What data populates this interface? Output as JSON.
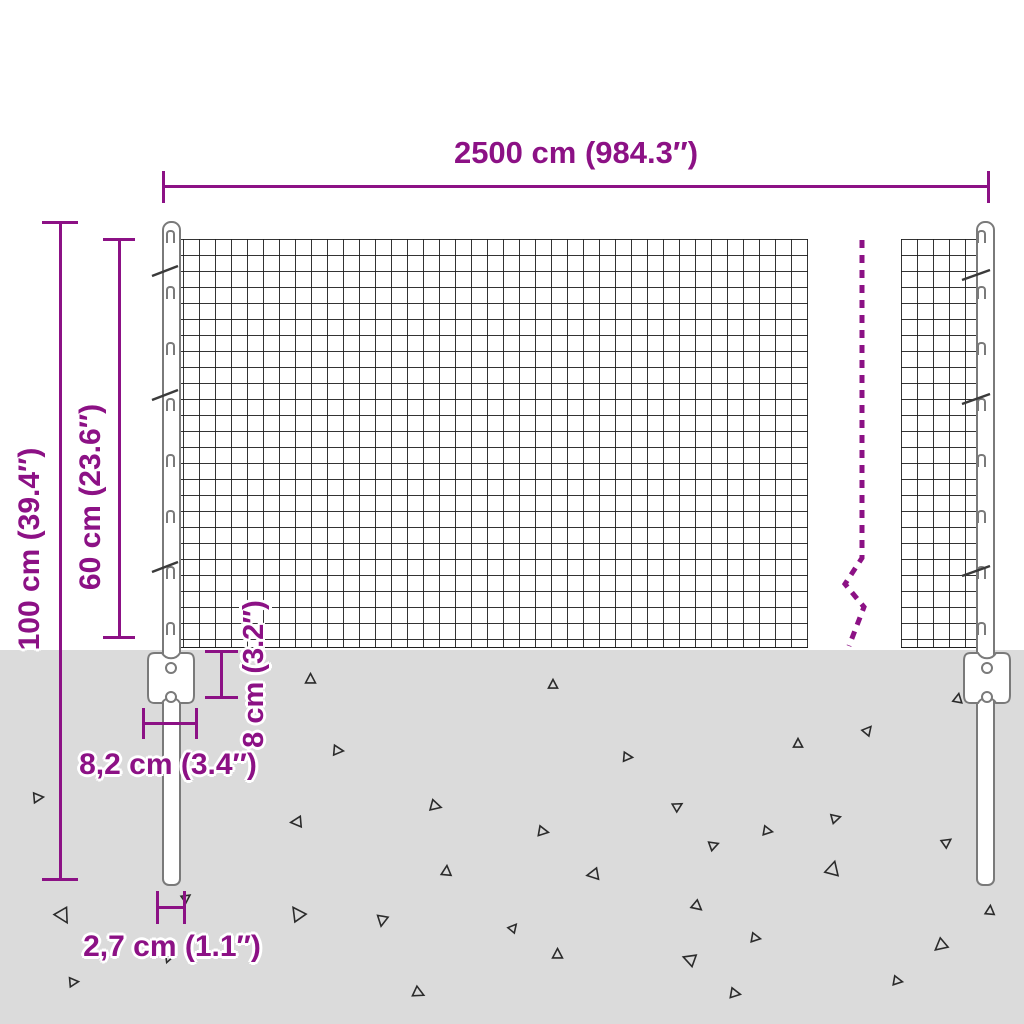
{
  "diagram": {
    "subject": "wire-mesh-fence-with-posts",
    "dimensions": {
      "width_label": "2500 cm (984.3″)",
      "total_height_label": "100 cm (39.4″)",
      "mesh_height_label": "60 cm (23.6″)",
      "bracket_height_label": "8 cm (3.2″)",
      "bracket_width_label": "8,2 cm (3.4″)",
      "post_diameter_label": "2,7 cm (1.1″)"
    }
  },
  "colors": {
    "accent": "#8C1185",
    "ground": "#DBDBDB",
    "mesh_line": "#1E1E1E",
    "post_outline": "#7A7A7A",
    "triangle": "#2B2B2B"
  },
  "ground": {
    "triangles": [
      {
        "x": 38,
        "y": 797,
        "s": 13,
        "r": 85
      },
      {
        "x": 63,
        "y": 916,
        "s": 19,
        "r": 150
      },
      {
        "x": 74,
        "y": 982,
        "s": 12,
        "r": 85
      },
      {
        "x": 186,
        "y": 897,
        "s": 11,
        "r": 55
      },
      {
        "x": 168,
        "y": 959,
        "s": 10,
        "r": 200
      },
      {
        "x": 296,
        "y": 822,
        "s": 14,
        "r": -95
      },
      {
        "x": 297,
        "y": 913,
        "s": 18,
        "r": -35
      },
      {
        "x": 310,
        "y": 678,
        "s": 13,
        "r": 0
      },
      {
        "x": 338,
        "y": 750,
        "s": 13,
        "r": 95
      },
      {
        "x": 382,
        "y": 921,
        "s": 14,
        "r": 190
      },
      {
        "x": 419,
        "y": 993,
        "s": 14,
        "r": 115
      },
      {
        "x": 436,
        "y": 806,
        "s": 14,
        "r": 105
      },
      {
        "x": 446,
        "y": 870,
        "s": 13,
        "r": 5
      },
      {
        "x": 543,
        "y": 831,
        "s": 13,
        "r": 100
      },
      {
        "x": 513,
        "y": 927,
        "s": 11,
        "r": 40
      },
      {
        "x": 553,
        "y": 684,
        "s": 12,
        "r": 0
      },
      {
        "x": 557,
        "y": 953,
        "s": 13,
        "r": 0
      },
      {
        "x": 592,
        "y": 874,
        "s": 15,
        "r": -100
      },
      {
        "x": 628,
        "y": 757,
        "s": 12,
        "r": 95
      },
      {
        "x": 678,
        "y": 806,
        "s": 12,
        "r": 60
      },
      {
        "x": 689,
        "y": 959,
        "s": 16,
        "r": -70
      },
      {
        "x": 697,
        "y": 906,
        "s": 13,
        "r": 130
      },
      {
        "x": 714,
        "y": 845,
        "s": 12,
        "r": 70
      },
      {
        "x": 735,
        "y": 993,
        "s": 13,
        "r": 100
      },
      {
        "x": 756,
        "y": 938,
        "s": 12,
        "r": 100
      },
      {
        "x": 768,
        "y": 831,
        "s": 12,
        "r": 100
      },
      {
        "x": 798,
        "y": 743,
        "s": 12,
        "r": 0
      },
      {
        "x": 833,
        "y": 868,
        "s": 18,
        "r": 15
      },
      {
        "x": 836,
        "y": 818,
        "s": 12,
        "r": 75
      },
      {
        "x": 868,
        "y": 730,
        "s": 12,
        "r": 40
      },
      {
        "x": 898,
        "y": 981,
        "s": 12,
        "r": 100
      },
      {
        "x": 940,
        "y": 946,
        "s": 16,
        "r": -130
      },
      {
        "x": 947,
        "y": 842,
        "s": 12,
        "r": 55
      },
      {
        "x": 958,
        "y": 698,
        "s": 12,
        "r": 10
      },
      {
        "x": 990,
        "y": 910,
        "s": 12,
        "r": 5
      }
    ]
  }
}
